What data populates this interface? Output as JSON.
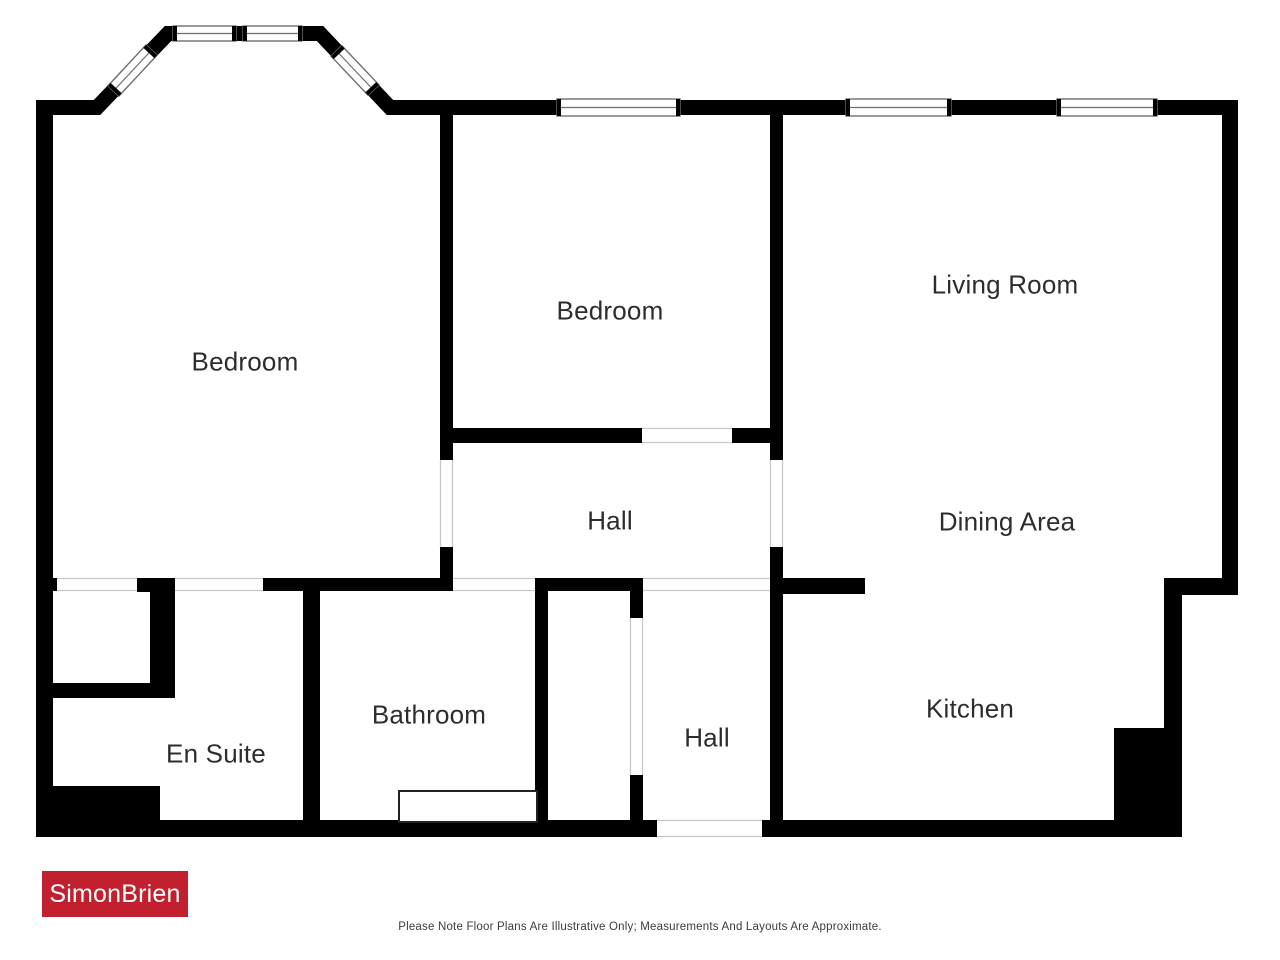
{
  "branding": {
    "logo_text": "SimonBrien",
    "logo_bg": "#c2202f",
    "logo_text_color": "#ffffff"
  },
  "footer": {
    "disclaimer": "Please Note Floor Plans Are Illustrative Only; Measurements And Layouts Are Approximate."
  },
  "floor_plan": {
    "wall_color": "#000000",
    "window_frame_color": "#6e6e6e",
    "opening_line_color": "#c9c9c9",
    "label_color": "#2d2d2d",
    "rooms": [
      {
        "id": "bedroom-left",
        "label": "Bedroom"
      },
      {
        "id": "bedroom-middle",
        "label": "Bedroom"
      },
      {
        "id": "living-room",
        "label": "Living Room"
      },
      {
        "id": "hall-upper",
        "label": "Hall"
      },
      {
        "id": "dining-area",
        "label": "Dining Area"
      },
      {
        "id": "en-suite",
        "label": "En Suite"
      },
      {
        "id": "bathroom",
        "label": "Bathroom"
      },
      {
        "id": "hall-lower",
        "label": "Hall"
      },
      {
        "id": "kitchen",
        "label": "Kitchen"
      }
    ]
  }
}
